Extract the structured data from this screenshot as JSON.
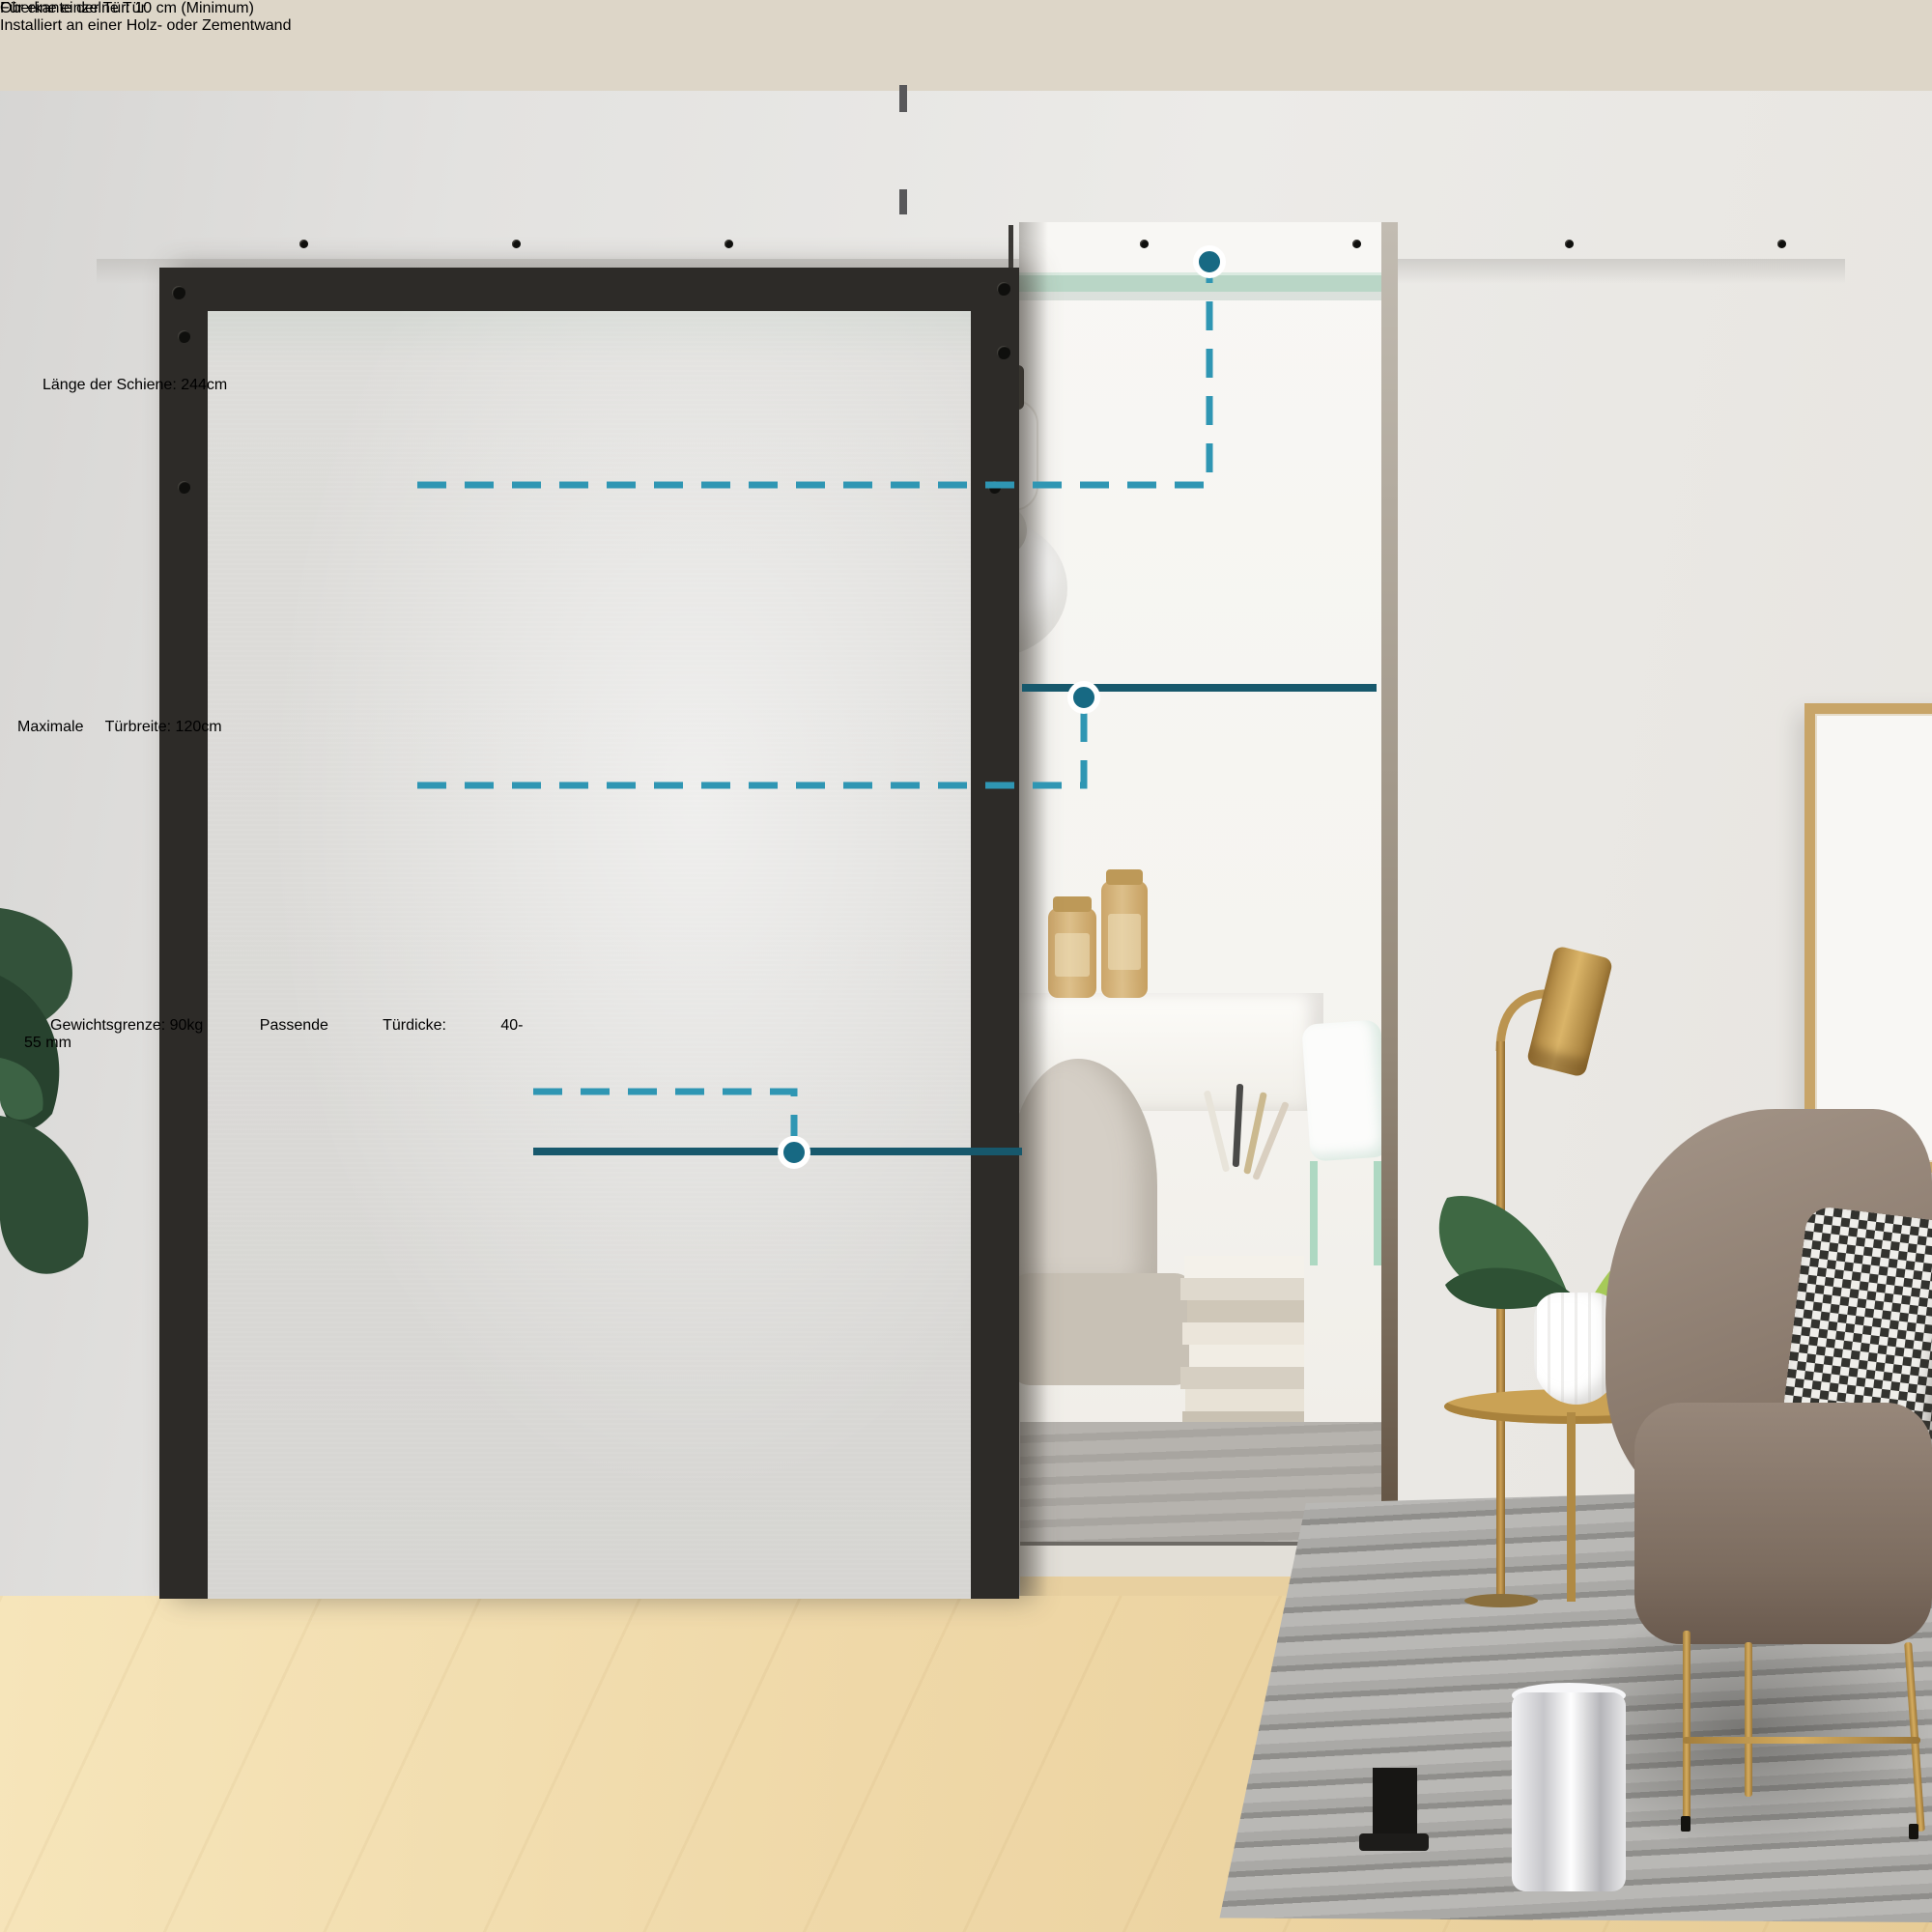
{
  "top_annotation": {
    "text": "Oberkante der Tür: 10 cm (Minimum)"
  },
  "callout_rail_length": {
    "label": "Länge der Schiene:",
    "value": "244cm"
  },
  "callout_door_width": {
    "line1": "Maximale",
    "line2": "Türbreite: 120cm"
  },
  "callout_weight": {
    "label": "Gewichtsgrenze:",
    "value": "90kg"
  },
  "callout_thickness": {
    "line1": "Passende",
    "line2": "Türdicke:",
    "line3": "40-55 mm"
  },
  "footer": {
    "line1": "Für eine einzelne Tür",
    "line2": "Installiert an einer Holz- oder Zementwand"
  },
  "colors": {
    "accent_dash": "#2f96b3",
    "accent_solid": "#17586c",
    "dot_fill": "#176983",
    "note_dash": "#58585a",
    "callout_bg": "rgba(93,96,99,0.9)",
    "callout_text": "#ffffff",
    "note_text": "#56595d",
    "footer_band": "#d8d3c6",
    "footer_text": "#4b5055",
    "top_band": "#ddd6c8",
    "rail_black": "#1d1c1a"
  }
}
